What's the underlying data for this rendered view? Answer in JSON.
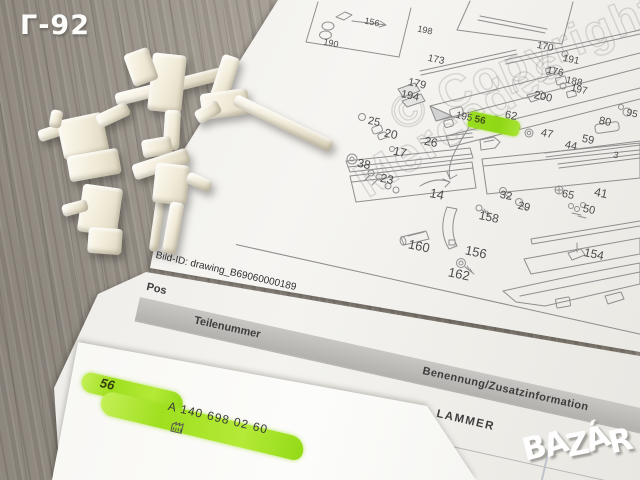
{
  "overlay": {
    "floor_label": "Г-92",
    "logo_text": "BAZÁR"
  },
  "drawing": {
    "bild_id": "Bild-ID: drawing_B69060000189",
    "watermark_line1": "© Copyright 20",
    "watermark_line2": "Mercedes",
    "highlight_chip_label": "56",
    "part_labels": [
      {
        "n": "156",
        "x": 372,
        "y": 22,
        "s": 9
      },
      {
        "n": "190",
        "x": 331,
        "y": 43,
        "s": 9
      },
      {
        "n": "198",
        "x": 425,
        "y": 30,
        "s": 9
      },
      {
        "n": "173",
        "x": 436,
        "y": 60,
        "s": 10
      },
      {
        "n": "170",
        "x": 545,
        "y": 47,
        "s": 10
      },
      {
        "n": "191",
        "x": 571,
        "y": 60,
        "s": 10
      },
      {
        "n": "176",
        "x": 555,
        "y": 72,
        "s": 10
      },
      {
        "n": "188",
        "x": 574,
        "y": 82,
        "s": 10
      },
      {
        "n": "197",
        "x": 579,
        "y": 90,
        "s": 10
      },
      {
        "n": "200",
        "x": 543,
        "y": 97,
        "s": 11
      },
      {
        "n": "179",
        "x": 417,
        "y": 84,
        "s": 11
      },
      {
        "n": "194",
        "x": 410,
        "y": 96,
        "s": 11
      },
      {
        "n": "195",
        "x": 464,
        "y": 117,
        "s": 10
      },
      {
        "n": "62",
        "x": 511,
        "y": 116,
        "s": 11
      },
      {
        "n": "80",
        "x": 605,
        "y": 122,
        "s": 11
      },
      {
        "n": "95",
        "x": 632,
        "y": 114,
        "s": 10
      },
      {
        "n": "47",
        "x": 547,
        "y": 134,
        "s": 11
      },
      {
        "n": "59",
        "x": 588,
        "y": 140,
        "s": 11
      },
      {
        "n": "44",
        "x": 571,
        "y": 146,
        "s": 11
      },
      {
        "n": "3",
        "x": 616,
        "y": 155,
        "s": 9
      },
      {
        "n": "25",
        "x": 374,
        "y": 122,
        "s": 11
      },
      {
        "n": "20",
        "x": 391,
        "y": 134,
        "s": 12
      },
      {
        "n": "17",
        "x": 400,
        "y": 152,
        "s": 12
      },
      {
        "n": "26",
        "x": 431,
        "y": 142,
        "s": 12
      },
      {
        "n": "38",
        "x": 364,
        "y": 164,
        "s": 12
      },
      {
        "n": "23",
        "x": 387,
        "y": 179,
        "s": 12
      },
      {
        "n": "14",
        "x": 437,
        "y": 194,
        "s": 13
      },
      {
        "n": "32",
        "x": 506,
        "y": 196,
        "s": 11
      },
      {
        "n": "29",
        "x": 524,
        "y": 207,
        "s": 11
      },
      {
        "n": "65",
        "x": 568,
        "y": 195,
        "s": 11
      },
      {
        "n": "41",
        "x": 601,
        "y": 193,
        "s": 12
      },
      {
        "n": "50",
        "x": 589,
        "y": 210,
        "s": 11
      },
      {
        "n": "158",
        "x": 489,
        "y": 217,
        "s": 12
      },
      {
        "n": "160",
        "x": 419,
        "y": 246,
        "s": 13
      },
      {
        "n": "156",
        "x": 476,
        "y": 252,
        "s": 13
      },
      {
        "n": "162",
        "x": 459,
        "y": 274,
        "s": 13
      },
      {
        "n": "154",
        "x": 594,
        "y": 254,
        "s": 12
      }
    ]
  },
  "table": {
    "col_pos": "Pos",
    "col_teilenummer": "Teilenummer",
    "col_benennung": "Benennung/Zusatzinformation",
    "row_benennung_visible": "LAMMER"
  },
  "highlight_row": {
    "pos": "56",
    "teilenummer": "A 140 698 02 60"
  },
  "colors": {
    "highlighter": "#a6e32b",
    "paper": "#f3f2ee",
    "paper_front": "#fbfbf9",
    "wood": "#a29a8f",
    "band": "#bfbdba"
  }
}
